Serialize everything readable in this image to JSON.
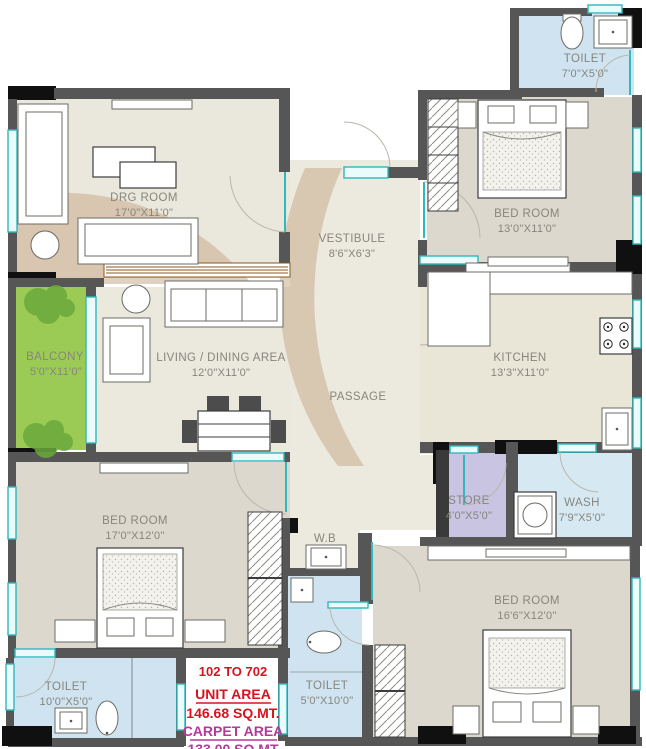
{
  "plan": {
    "title": "Residential unit floor plan",
    "unit_range": "102 TO 702",
    "unit_area_label": "UNIT AREA",
    "unit_area_value": "146.68 SQ.MT.",
    "carpet_area_label": "CARPET AREA",
    "carpet_area_value": "133.00 SQ.MT",
    "colors": {
      "wall_gray": "#565656",
      "pillar_black": "#101010",
      "window_cyan": "#2eb9bd",
      "floor_beige": "#ebe8dd",
      "bedroom_floor": "#ddd8cd",
      "toilet_blue": "#cfe4f0",
      "balcony_green": "#9bcb55",
      "store_lavender": "#c8c4e2",
      "tan_overlay": "#c9ab8d",
      "text_red": "#d9121f",
      "text_magenta": "#b5399b",
      "label_gray": "#87857c"
    }
  },
  "rooms": {
    "drg": {
      "label": "DRG ROOM",
      "dims": "17'0\"X11'0\""
    },
    "toilet_top": {
      "label": "TOILET",
      "dims": "7'0\"X5'0\""
    },
    "bed_top": {
      "label": "BED ROOM",
      "dims": "13'0\"X11'0\""
    },
    "vestibule": {
      "label": "VESTIBULE",
      "dims": "8'6\"X6'3\""
    },
    "balcony": {
      "label": "BALCONY",
      "dims": "5'0\"X11'0\""
    },
    "living": {
      "label": "LIVING / DINING AREA",
      "dims": "12'0\"X11'0\""
    },
    "kitchen": {
      "label": "KITCHEN",
      "dims": "13'3\"X11'0\""
    },
    "passage": {
      "label": "PASSAGE",
      "dims": ""
    },
    "store": {
      "label": "STORE",
      "dims": "4'0\"X5'0\""
    },
    "wash": {
      "label": "WASH",
      "dims": "7'9\"X5'0\""
    },
    "bed_left": {
      "label": "BED ROOM",
      "dims": "17'0\"X12'0\""
    },
    "wb": {
      "label": "W.B",
      "dims": ""
    },
    "bed_right": {
      "label": "BED ROOM",
      "dims": "16'6\"X12'0\""
    },
    "toilet_left": {
      "label": "TOILET",
      "dims": "10'0\"X5'0\""
    },
    "toilet_mid": {
      "label": "TOILET",
      "dims": "5'0\"X10'0\""
    }
  }
}
